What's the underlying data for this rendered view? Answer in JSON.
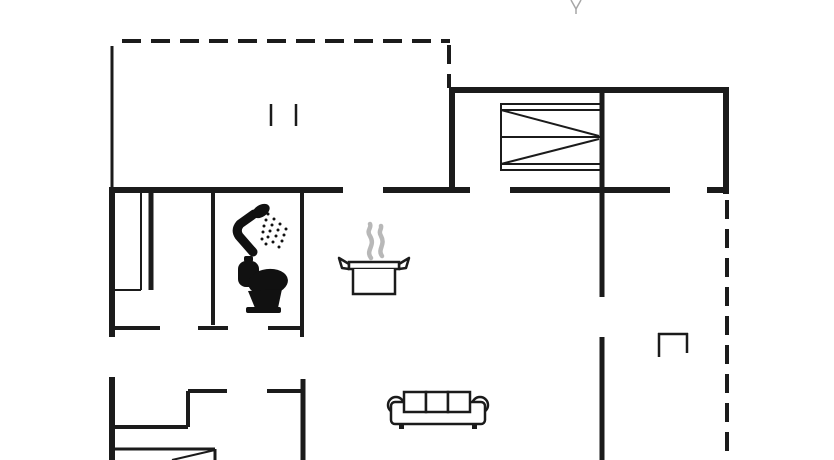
{
  "floorplan": {
    "canvas": {
      "width": 834,
      "height": 460
    },
    "colors": {
      "ink": "#1b1b1b",
      "steam": "#b8b8b8",
      "faint": "#a6a6a6",
      "background": "#ffffff"
    },
    "dash_pattern": "19 10",
    "walls_solid": [
      [
        112,
        46,
        112,
        190,
        3
      ],
      [
        449,
        90,
        729,
        90,
        6
      ],
      [
        452,
        87,
        452,
        193,
        6
      ],
      [
        726,
        87,
        726,
        194,
        6
      ],
      [
        109,
        190,
        343,
        190,
        6
      ],
      [
        383,
        190,
        470,
        190,
        6
      ],
      [
        510,
        190,
        670,
        190,
        6
      ],
      [
        707,
        190,
        729,
        190,
        6
      ],
      [
        112,
        187,
        112,
        337,
        6
      ],
      [
        112,
        377,
        112,
        460,
        6
      ],
      [
        602,
        93,
        602,
        297,
        5
      ],
      [
        602,
        337,
        602,
        460,
        5
      ],
      [
        213,
        190,
        213,
        325,
        4
      ],
      [
        302,
        190,
        302,
        337,
        4
      ],
      [
        151,
        191,
        151,
        290,
        5
      ],
      [
        141,
        192,
        141,
        290,
        2
      ],
      [
        112,
        290,
        141,
        290,
        2
      ],
      [
        113,
        328,
        160,
        328,
        4
      ],
      [
        198,
        328,
        228,
        328,
        4
      ],
      [
        268,
        328,
        302,
        328,
        4
      ],
      [
        188,
        391,
        227,
        391,
        4
      ],
      [
        267,
        391,
        303,
        391,
        4
      ],
      [
        188,
        391,
        188,
        427,
        4
      ],
      [
        112,
        427,
        188,
        427,
        4
      ],
      [
        303,
        379,
        303,
        460,
        5
      ],
      [
        114,
        449,
        215,
        449,
        3
      ],
      [
        215,
        449,
        215,
        460,
        3
      ],
      [
        215,
        450,
        172,
        460,
        2
      ]
    ],
    "walls_dashed": [
      [
        122,
        41,
        450,
        41,
        4
      ],
      [
        449,
        45,
        449,
        88,
        4
      ],
      [
        727,
        200,
        727,
        460,
        4
      ]
    ],
    "symbols": [
      {
        "name": "bunk-bed-icon",
        "x": 501,
        "y": 104
      },
      {
        "name": "shower-icon",
        "x": 228,
        "y": 198
      },
      {
        "name": "toilet-icon",
        "x": 234,
        "y": 255
      },
      {
        "name": "cooking-pot-icon",
        "x": 336,
        "y": 222
      },
      {
        "name": "sofa-icon",
        "x": 387,
        "y": 388
      },
      {
        "name": "wood-stove-icon",
        "x": 658,
        "y": 333
      },
      {
        "name": "window-marks-icon",
        "x": 271,
        "y": 104
      },
      {
        "name": "north-arrow-fragment-icon",
        "x": 569,
        "y": 0
      }
    ]
  }
}
